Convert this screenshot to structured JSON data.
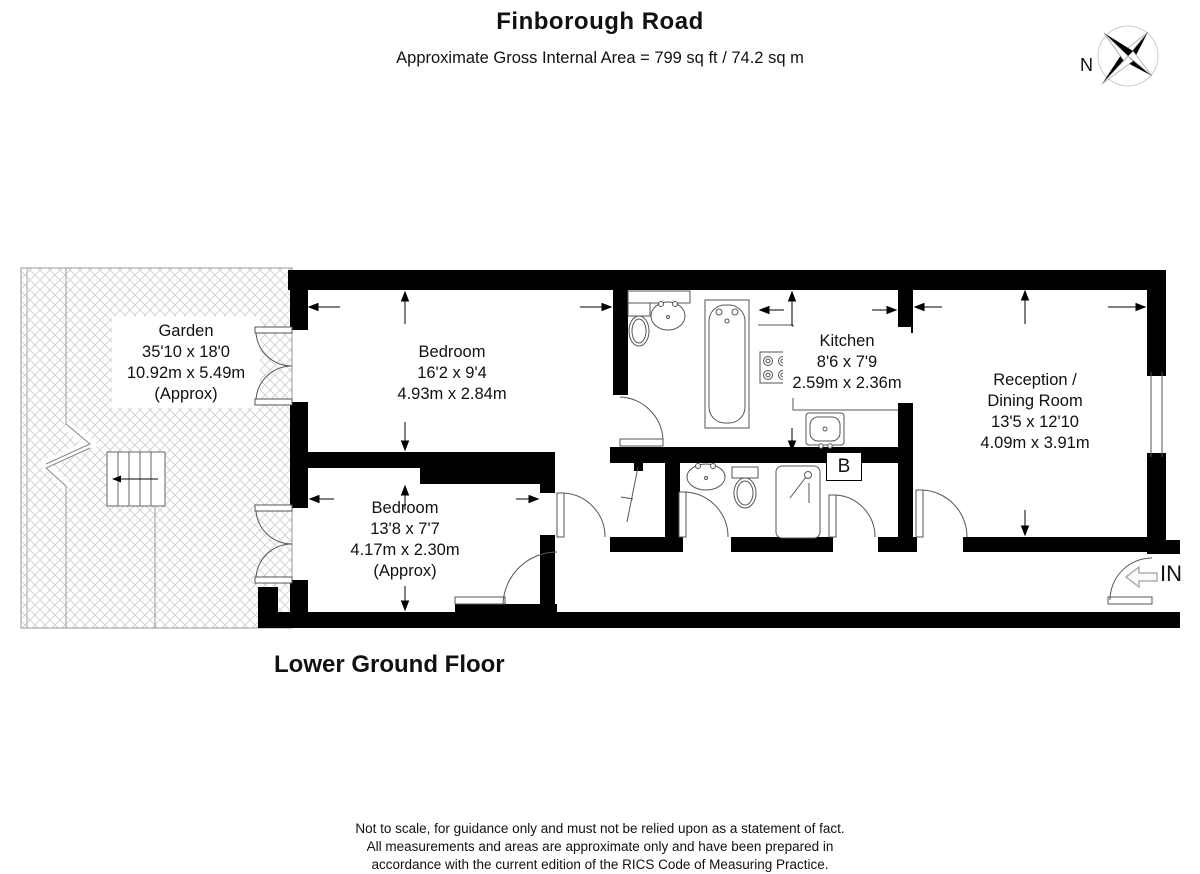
{
  "header": {
    "title": "Finborough Road",
    "subtitle": "Approximate Gross Internal Area = 799 sq ft / 74.2 sq m",
    "compass_label": "N"
  },
  "floor": {
    "name_label": "Lower Ground Floor",
    "entrance_label": "IN",
    "boiler_label": "B"
  },
  "rooms": {
    "garden": {
      "name": "Garden",
      "dims_ft": "35'10 x 18'0",
      "dims_m": "10.92m x 5.49m",
      "note": "(Approx)"
    },
    "bedroom1": {
      "name": "Bedroom",
      "dims_ft": "16'2 x 9'4",
      "dims_m": "4.93m x 2.84m"
    },
    "kitchen": {
      "name": "Kitchen",
      "dims_ft": "8'6 x 7'9",
      "dims_m": "2.59m x 2.36m"
    },
    "reception": {
      "name": "Reception /",
      "name2": "Dining Room",
      "dims_ft": "13'5 x 12'10",
      "dims_m": "4.09m x 3.91m"
    },
    "bedroom2": {
      "name": "Bedroom",
      "dims_ft": "13'8 x 7'7",
      "dims_m": "4.17m x 2.30m",
      "note": "(Approx)"
    }
  },
  "footer": {
    "line1": "Not to scale, for guidance only and must not be relied upon as a statement of fact.",
    "line2": "All measurements and areas are approximate only and have been prepared in",
    "line3": "accordance with the current edition of the RICS Code of Measuring Practice."
  },
  "colors": {
    "wall": "#000000",
    "thin_line": "#555555",
    "hatch": "#cccccc"
  }
}
